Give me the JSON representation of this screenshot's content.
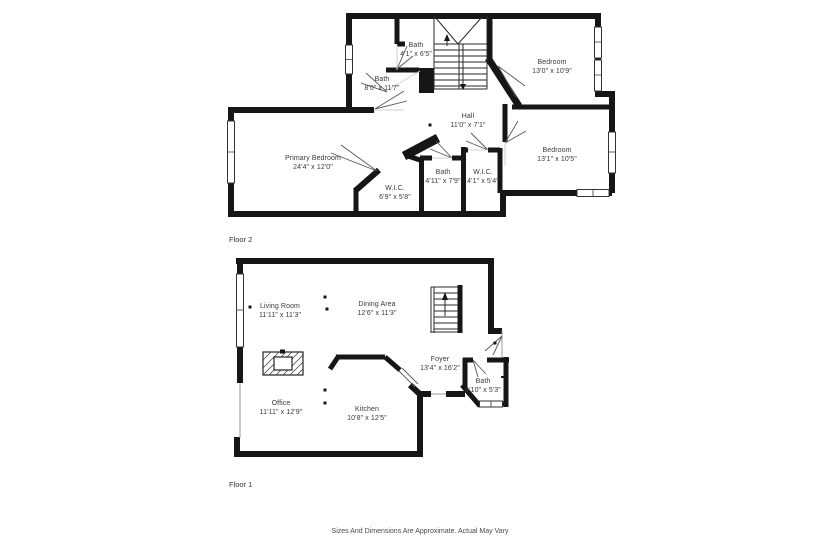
{
  "title": "Two-floor residential floor plan",
  "colors": {
    "walls": "#161616",
    "label_text": "#3a3a3a",
    "background": "#ffffff"
  },
  "floors": [
    {
      "label": "Floor 2",
      "rooms": [
        {
          "name": "Bath",
          "dims": "4'1\" x 6'5\""
        },
        {
          "name": "Bath",
          "dims": "8'0\" x 11'7\""
        },
        {
          "name": "Bedroom",
          "dims": "13'0\" x 10'9\""
        },
        {
          "name": "Hall",
          "dims": "11'0\" x 7'1\""
        },
        {
          "name": "Primary Bedroom",
          "dims": "24'4\" x 12'0\""
        },
        {
          "name": "Bedroom",
          "dims": "13'1\" x 10'5\""
        },
        {
          "name": "W.I.C.",
          "dims": "6'9\" x 5'8\""
        },
        {
          "name": "Bath",
          "dims": "4'11\" x 7'9\""
        },
        {
          "name": "W.I.C.",
          "dims": "4'1\" x 5'4\""
        }
      ]
    },
    {
      "label": "Floor 1",
      "rooms": [
        {
          "name": "Living Room",
          "dims": "11'11\" x 11'3\""
        },
        {
          "name": "Dining Area",
          "dims": "12'6\" x 11'3\""
        },
        {
          "name": "Foyer",
          "dims": "13'4\" x 16'2\""
        },
        {
          "name": "Bath",
          "dims": "4'10\" x 5'3\""
        },
        {
          "name": "Office",
          "dims": "11'11\" x 12'9\""
        },
        {
          "name": "Kitchen",
          "dims": "10'8\" x 12'5\""
        }
      ]
    }
  ],
  "disclaimer": "Sizes And Dimensions Are Approximate. Actual May Vary"
}
